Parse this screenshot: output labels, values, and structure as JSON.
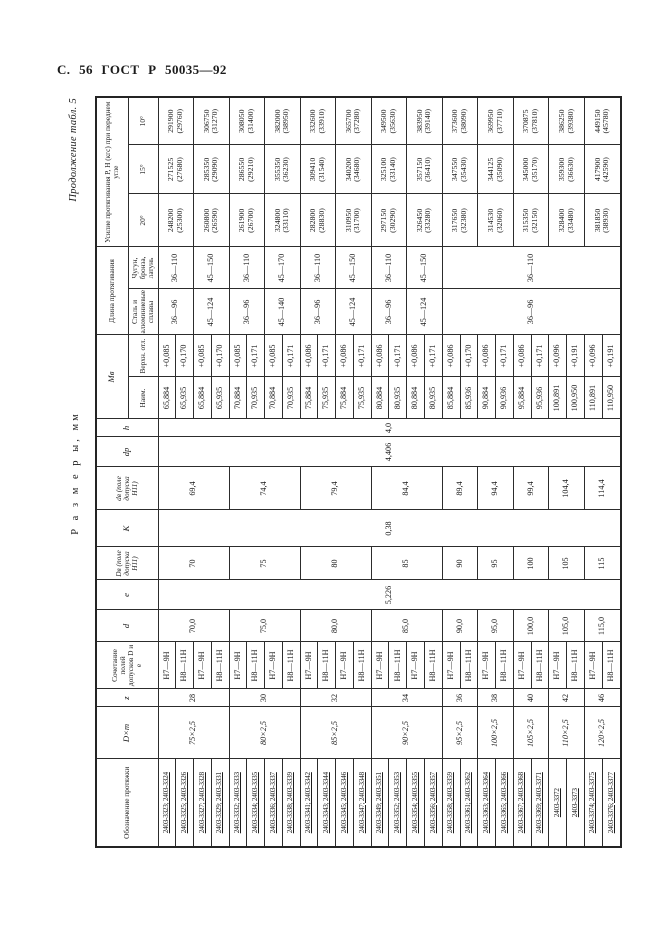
{
  "page": {
    "header_left": "С. 56 ГОСТ Р 50035—92",
    "continuation_note": "Продолжение табл. 5",
    "size_note": "Р а з м е р ы,  мм"
  },
  "table": {
    "headers": {
      "designation": "Обозначение протяжки",
      "dxm": "D×m",
      "z": "z",
      "tolerance_combo": "Сочетание полей допусков D и е",
      "d": "d",
      "e": "e",
      "Dv": "Dв (поле допуска Н11)",
      "K": "K",
      "dv": "dв (поле допуска Н11)",
      "dp": "dр",
      "h": "h",
      "Mv": "Мв",
      "Mv_min": "Наим.",
      "Mv_dev": "Верхн. отл.",
      "length": "Длина протягивания",
      "length_steel": "Сталь и алюминиевые сплавы",
      "length_iron": "Чугун, бронза, латунь",
      "force": "Усилие протягивания Р, Н (кгс) при переднем угле",
      "force_20": "20°",
      "force_15": "15°",
      "force_10": "10°"
    },
    "shared": {
      "e": "5,226",
      "K": "0,38",
      "dp": "4,406",
      "h": "4,0"
    },
    "groups": [
      {
        "dxm": "75×2,5",
        "z": "28",
        "d": "70,0",
        "Dv": "70",
        "dv": "69,4",
        "pairs": [
          {
            "rows": [
              {
                "designation": "2403-3323; 2403-3324",
                "combo": "Н7—9Н",
                "Mv_min": "65,884",
                "Mv_dev": "+0,085"
              },
              {
                "designation": "2403-3325; 2403-3326",
                "combo": "Н8—11Н",
                "Mv_min": "65,935",
                "Mv_dev": "+0,170"
              }
            ],
            "length": {
              "steel": "36—96",
              "iron": "36—110",
              "span": 2
            },
            "force_20": {
              "n": "248200",
              "k": "(25300)"
            },
            "force_15": {
              "n": "271525",
              "k": "(27680)"
            },
            "force_10": {
              "n": "291900",
              "k": "(29760)"
            }
          },
          {
            "rows": [
              {
                "designation": "2403-3327; 2403-3328",
                "combo": "Н7—9Н",
                "Mv_min": "65,884",
                "Mv_dev": "+0,085"
              },
              {
                "designation": "2403-3329; 2403-3331",
                "combo": "Н8—11Н",
                "Mv_min": "65,935",
                "Mv_dev": "+0,170"
              }
            ],
            "length": {
              "steel": "45—124",
              "iron": "45—150",
              "span": 2
            },
            "force_20": {
              "n": "260800",
              "k": "(26590)"
            },
            "force_15": {
              "n": "285350",
              "k": "(29090)"
            },
            "force_10": {
              "n": "306750",
              "k": "(31270)"
            }
          }
        ]
      },
      {
        "dxm": "80×2,5",
        "z": "30",
        "d": "75,0",
        "Dv": "75",
        "dv": "74,4",
        "pairs": [
          {
            "rows": [
              {
                "designation": "2403-3332; 2403-3333",
                "combo": "Н7—9Н",
                "Mv_min": "70,884",
                "Mv_dev": "+0,085"
              },
              {
                "designation": "2403-3334; 2403-3335",
                "combo": "Н8—11Н",
                "Mv_min": "70,935",
                "Mv_dev": "+0,171"
              }
            ],
            "length": {
              "steel": "36—96",
              "iron": "36—110",
              "span": 2
            },
            "force_20": {
              "n": "261900",
              "k": "(26700)"
            },
            "force_15": {
              "n": "286550",
              "k": "(29210)"
            },
            "force_10": {
              "n": "308050",
              "k": "(31400)"
            }
          },
          {
            "rows": [
              {
                "designation": "2403-3336; 2403-3337",
                "combo": "Н7—9Н",
                "Mv_min": "70,884",
                "Mv_dev": "+0,085"
              },
              {
                "designation": "2403-3338; 2403-3339",
                "combo": "Н8—11Н",
                "Mv_min": "70,935",
                "Mv_dev": "+0,171"
              }
            ],
            "length": {
              "steel": "45—140",
              "iron": "45—170",
              "span": 2
            },
            "force_20": {
              "n": "324800",
              "k": "(33110)"
            },
            "force_15": {
              "n": "355350",
              "k": "(36230)"
            },
            "force_10": {
              "n": "382000",
              "k": "(38950)"
            }
          }
        ]
      },
      {
        "dxm": "85×2,5",
        "z": "32",
        "d": "80,0",
        "Dv": "80",
        "dv": "79,4",
        "pairs": [
          {
            "rows": [
              {
                "designation": "2403-3341; 2403-3342",
                "combo": "Н7—9Н",
                "Mv_min": "75,884",
                "Mv_dev": "+0,086"
              },
              {
                "designation": "2403-3343; 2403-3344",
                "combo": "Н8—11Н",
                "Mv_min": "75,935",
                "Mv_dev": "+0,171"
              }
            ],
            "length": {
              "steel": "36—96",
              "iron": "36—110",
              "span": 2
            },
            "force_20": {
              "n": "282800",
              "k": "(28830)"
            },
            "force_15": {
              "n": "309410",
              "k": "(31540)"
            },
            "force_10": {
              "n": "332600",
              "k": "(33910)"
            }
          },
          {
            "rows": [
              {
                "designation": "2403-3345; 2403-3346",
                "combo": "Н7—9Н",
                "Mv_min": "75,884",
                "Mv_dev": "+0,086"
              },
              {
                "designation": "2403-3347; 2403-3348",
                "combo": "Н8—11Н",
                "Mv_min": "75,935",
                "Mv_dev": "+0,171"
              }
            ],
            "length": {
              "steel": "45—124",
              "iron": "45—150",
              "span": 2
            },
            "force_20": {
              "n": "310950",
              "k": "(31700)"
            },
            "force_15": {
              "n": "340200",
              "k": "(34680)"
            },
            "force_10": {
              "n": "365700",
              "k": "(37280)"
            }
          }
        ]
      },
      {
        "dxm": "90×2,5",
        "z": "34",
        "d": "85,0",
        "Dv": "85",
        "dv": "84,4",
        "pairs": [
          {
            "rows": [
              {
                "designation": "2403-3349; 2403-3351",
                "combo": "Н7—9Н",
                "Mv_min": "80,884",
                "Mv_dev": "+0,086"
              },
              {
                "designation": "2403-3352; 2403-3353",
                "combo": "Н8—11Н",
                "Mv_min": "80,935",
                "Mv_dev": "+0,171"
              }
            ],
            "length": {
              "steel": "36—96",
              "iron": "36—110",
              "span": 2
            },
            "force_20": {
              "n": "297150",
              "k": "(30290)"
            },
            "force_15": {
              "n": "325100",
              "k": "(33140)"
            },
            "force_10": {
              "n": "349500",
              "k": "(35630)"
            }
          },
          {
            "rows": [
              {
                "designation": "2403-3354; 2403-3355",
                "combo": "Н7—9Н",
                "Mv_min": "80,884",
                "Mv_dev": "+0,086"
              },
              {
                "designation": "2403-3356; 2403-3357",
                "combo": "Н8—11Н",
                "Mv_min": "80,935",
                "Mv_dev": "+0,171"
              }
            ],
            "length": {
              "steel": "45—124",
              "iron": "45—150",
              "span": 2
            },
            "force_20": {
              "n": "326450",
              "k": "(33280)"
            },
            "force_15": {
              "n": "357150",
              "k": "(36410)"
            },
            "force_10": {
              "n": "383950",
              "k": "(39140)"
            }
          }
        ]
      },
      {
        "dxm": "95×2,5",
        "z": "36",
        "d": "90,0",
        "Dv": "90",
        "dv": "89,4",
        "pairs": [
          {
            "rows": [
              {
                "designation": "2403-3358; 2403-3359",
                "combo": "Н7—9Н",
                "Mv_min": "85,884",
                "Mv_dev": "+0,086"
              },
              {
                "designation": "2403-3361; 2403-3362",
                "combo": "Н8—11Н",
                "Mv_min": "85,936",
                "Mv_dev": "+0,170"
              }
            ],
            "length": {
              "steel": "36—96",
              "iron": "36—110",
              "span": 10
            },
            "force_20": {
              "n": "317650",
              "k": "(32380)"
            },
            "force_15": {
              "n": "347550",
              "k": "(35430)"
            },
            "force_10": {
              "n": "373600",
              "k": "(38090)"
            }
          }
        ]
      },
      {
        "dxm": "100×2,5",
        "z": "38",
        "d": "95,0",
        "Dv": "95",
        "dv": "94,4",
        "pairs": [
          {
            "rows": [
              {
                "designation": "2403-3363; 2403-3364",
                "combo": "Н7—9Н",
                "Mv_min": "90,884",
                "Mv_dev": "+0,086"
              },
              {
                "designation": "2403-3365; 2403-3366",
                "combo": "Н8—11Н",
                "Mv_min": "90,936",
                "Mv_dev": "+0,171"
              }
            ],
            "length": null,
            "force_20": {
              "n": "314530",
              "k": "(32060)"
            },
            "force_15": {
              "n": "344125",
              "k": "(35090)"
            },
            "force_10": {
              "n": "369950",
              "k": "(37710)"
            }
          }
        ]
      },
      {
        "dxm": "105×2,5",
        "z": "40",
        "d": "100,0",
        "Dv": "100",
        "dv": "99,4",
        "pairs": [
          {
            "rows": [
              {
                "designation": "2403-3367; 2403-3368",
                "combo": "Н7—9Н",
                "Mv_min": "95,884",
                "Mv_dev": "+0,086"
              },
              {
                "designation": "2403-3369; 2403-3371",
                "combo": "Н8—11Н",
                "Mv_min": "95,936",
                "Mv_dev": "+0,171"
              }
            ],
            "length": null,
            "force_20": {
              "n": "315350",
              "k": "(32150)"
            },
            "force_15": {
              "n": "345000",
              "k": "(35170)"
            },
            "force_10": {
              "n": "370875",
              "k": "(37810)"
            }
          }
        ]
      },
      {
        "dxm": "110×2,5",
        "z": "42",
        "d": "105,0",
        "Dv": "105",
        "dv": "104,4",
        "pairs": [
          {
            "rows": [
              {
                "designation": "2403-3372",
                "combo": "Н7—9Н",
                "Mv_min": "100,891",
                "Mv_dev": "+0,096"
              },
              {
                "designation": "2403-3373",
                "combo": "Н8—11Н",
                "Mv_min": "100,950",
                "Mv_dev": "+0,191"
              }
            ],
            "length": null,
            "force_20": {
              "n": "328400",
              "k": "(33480)"
            },
            "force_15": {
              "n": "359300",
              "k": "(36630)"
            },
            "force_10": {
              "n": "386250",
              "k": "(39380)"
            }
          }
        ]
      },
      {
        "dxm": "120×2,5",
        "z": "46",
        "d": "115,0",
        "Dv": "115",
        "dv": "114,4",
        "pairs": [
          {
            "rows": [
              {
                "designation": "2403-3374; 2403-3375",
                "combo": "Н7—9Н",
                "Mv_min": "110,891",
                "Mv_dev": "+0,096"
              },
              {
                "designation": "2403-3376; 2403-3377",
                "combo": "Н8—11Н",
                "Mv_min": "110,950",
                "Mv_dev": "+0,191"
              }
            ],
            "length": null,
            "force_20": {
              "n": "381850",
              "k": "(38930)"
            },
            "force_15": {
              "n": "417900",
              "k": "(42590)"
            },
            "force_10": {
              "n": "449150",
              "k": "(45780)"
            }
          }
        ]
      }
    ]
  }
}
